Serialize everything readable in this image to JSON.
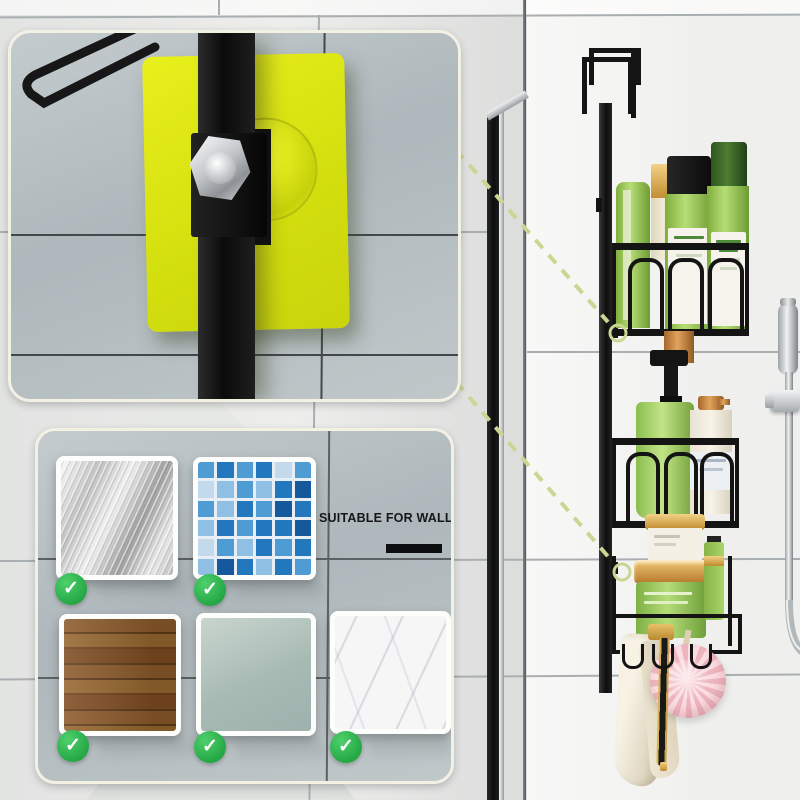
{
  "suitability": {
    "title": "SUITABLE FOR WALLS",
    "checkmark": "✓",
    "check_color": "#2db84c",
    "underline_color": "#0d0e0f",
    "swatches": [
      "stainless-steel",
      "blue-mosaic-tile",
      "wood",
      "frosted-glass",
      "marble"
    ]
  },
  "mosaic": {
    "rows": 6,
    "cols": 6,
    "palette": [
      "#8fc0e4",
      "#4f9bd4",
      "#2377bd",
      "#15599c",
      "#c3d9ec",
      "#abcbe6"
    ],
    "cells": [
      1,
      2,
      1,
      2,
      4,
      1,
      4,
      0,
      1,
      0,
      2,
      3,
      1,
      0,
      2,
      1,
      3,
      2,
      0,
      2,
      1,
      2,
      2,
      3,
      4,
      1,
      0,
      2,
      1,
      2,
      0,
      3,
      2,
      0,
      2,
      1
    ]
  },
  "detail_panel": {
    "plate_color": "#dbe414",
    "bracket_color": "#121212",
    "bolt_color": "#c9ccce"
  },
  "scene": {
    "wall_color": "#efefed",
    "grout_color": "#a9aeb0",
    "callout_color": "#ccd693",
    "caddy_color": "#141414",
    "chrome_color": "#c7cbce",
    "bottle_green": "#9cc95c",
    "gold": "#d8a43c",
    "towel": "#f1ebdb",
    "flower_pink": "#f6ccd2"
  }
}
